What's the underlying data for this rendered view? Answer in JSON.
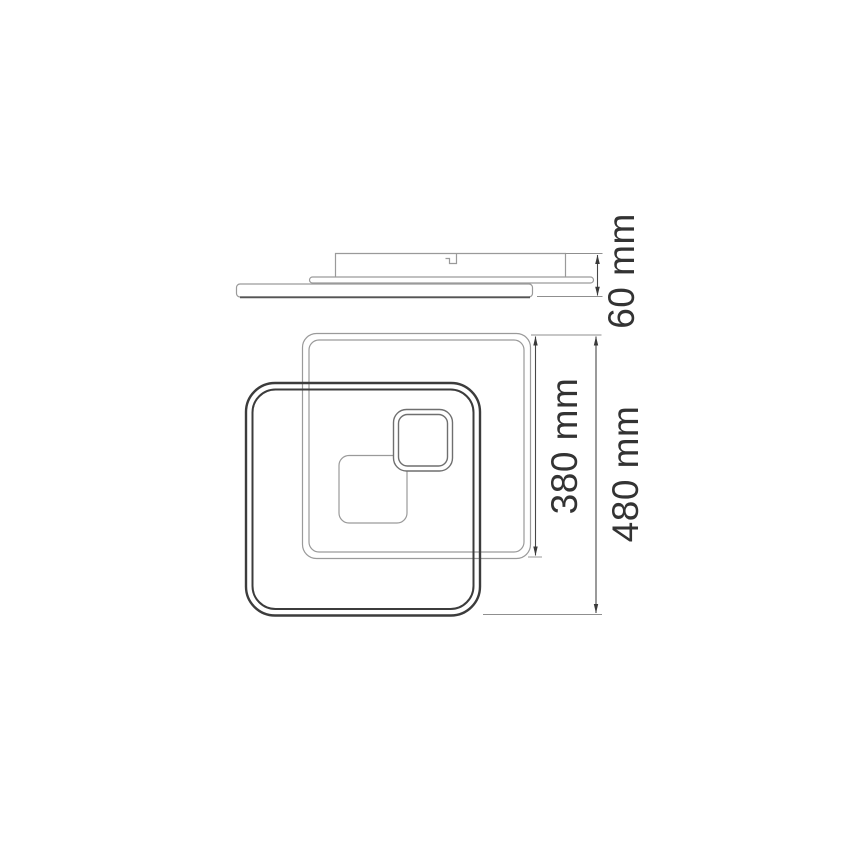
{
  "drawing": {
    "type": "technical-dimension-drawing",
    "views": {
      "side_view": {
        "dimension": {
          "label": "60 mm"
        }
      },
      "front_view": {
        "dimensions": {
          "inner_frame": {
            "label": "380 mm"
          },
          "overall": {
            "label": "480 mm"
          }
        }
      }
    },
    "colors": {
      "background": "#ffffff",
      "thin_line": "#9a9a9a",
      "dark_line": "#3c3c3c",
      "dimension_line": "#474747",
      "text": "#333333"
    }
  }
}
